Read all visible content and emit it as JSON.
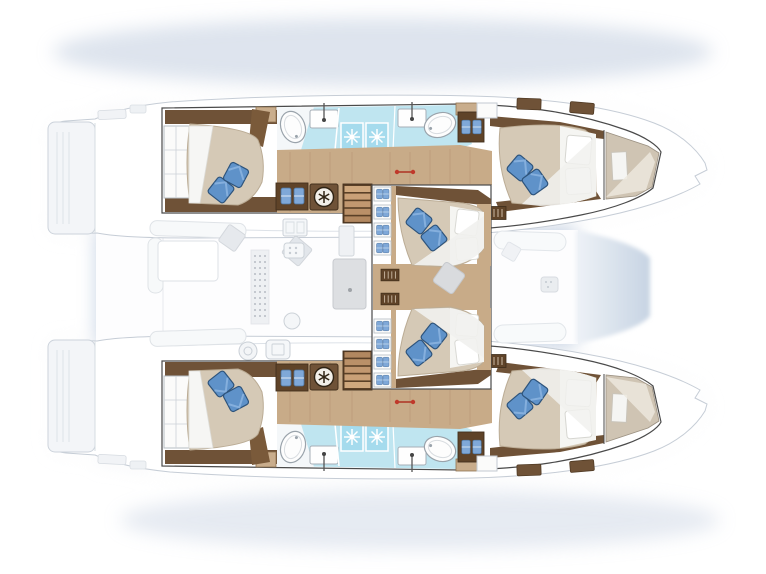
{
  "page": {
    "title": "Catamaran 6-cabin layout — top-down deck plan"
  },
  "palette": {
    "shadow": "#a5b9d4",
    "hull": "#ffffff",
    "outline": "#4a4a4a",
    "deck_faint": "#eef1f4",
    "wood_floor": "#c8ab88",
    "wood_dark": "#6f5237",
    "bed_duvet": "#d5c9b6",
    "linen_white": "#f5f5f2",
    "pillow_blue": "#5f92c9",
    "pillow_blue_edge": "#2e547c",
    "towel_blue": "#7fa8d8",
    "bath_floor": "#bfe5f0",
    "shower_glass": "#a5dbed",
    "trampoline": "#d3deea",
    "accent_red": "#c0392b",
    "furniture_faint": "#e4e7eb"
  },
  "vessel": {
    "type": "sailing catamaran deck plan",
    "view": "overhead",
    "bow_direction": "right",
    "hulls": 2,
    "double_cabins": 6,
    "shower_cubicles": 4,
    "washbasins": 4,
    "shower_trays": 4,
    "companionway_stairs": 2,
    "towel_lockers": 4,
    "climate_dials": 2
  },
  "port_hull": {
    "position": "top",
    "rooms": [
      {
        "name": "aft cabin",
        "bed": "island double bed",
        "blue_pillows": 2,
        "features": [
          "wardrobe with shelves",
          "dark wood trim",
          "headboard locker"
        ]
      },
      {
        "name": "bathroom",
        "floor": "light blue tile",
        "fixtures": [
          "oval shower tray",
          "washbasin with mixer",
          "glass shower cubicle x2",
          "washbasin with mixer",
          "oval shower tray",
          "forward locker"
        ]
      },
      {
        "name": "dressing counter",
        "fixtures": [
          "towel locker (2 blue towels)",
          "climate control dial (snowflake)"
        ]
      },
      {
        "name": "companionway",
        "steps": 5
      },
      {
        "name": "mid cabin (inboard)",
        "bed": "island double bed",
        "blue_pillows": 2,
        "features": [
          "storage steps with towels x4",
          "vent grille",
          "white head pillows x2"
        ]
      },
      {
        "name": "forward cabin",
        "bed": "island double bed",
        "blue_pillows": 2,
        "features": [
          "white head pillows x2",
          "sloped wood trim"
        ]
      },
      {
        "name": "forepeak",
        "contents": [
          "berth cushion",
          "deck hatch"
        ]
      }
    ]
  },
  "starboard_hull": {
    "position": "bottom",
    "note": "mirror image of port hull",
    "rooms": [
      {
        "name": "aft cabin",
        "bed": "island double bed",
        "blue_pillows": 2
      },
      {
        "name": "bathroom",
        "fixtures": [
          "oval shower tray x2",
          "washbasin x2",
          "glass shower cubicle x2",
          "towel locker"
        ]
      },
      {
        "name": "dressing counter",
        "fixtures": [
          "towel locker (2 blue towels)",
          "climate control dial (snowflake)"
        ]
      },
      {
        "name": "companionway",
        "steps": 5
      },
      {
        "name": "mid cabin (inboard)",
        "bed": "island double bed",
        "blue_pillows": 2
      },
      {
        "name": "forward cabin",
        "bed": "island double bed",
        "blue_pillows": 2
      },
      {
        "name": "forepeak",
        "contents": [
          "berth cushion",
          "deck hatch"
        ]
      }
    ]
  },
  "bridgedeck": {
    "aft_cockpit": [
      "L-shaped bench sofa",
      "cockpit table",
      "scatter cushion x2"
    ],
    "galley_saloon": [
      "double sink",
      "locker grid panel",
      "fridge",
      "hob dial",
      "control panel",
      "round basin",
      "vented louver panel"
    ],
    "centerline": [
      "sliding door / mast base panel",
      "grey deck cushion",
      "red hatch pulls (2 per hull)"
    ],
    "foredeck": [
      "forward cockpit bench x2",
      "storage box",
      "trampoline between bows"
    ],
    "stern": [
      "swim platform with steps x2"
    ]
  }
}
